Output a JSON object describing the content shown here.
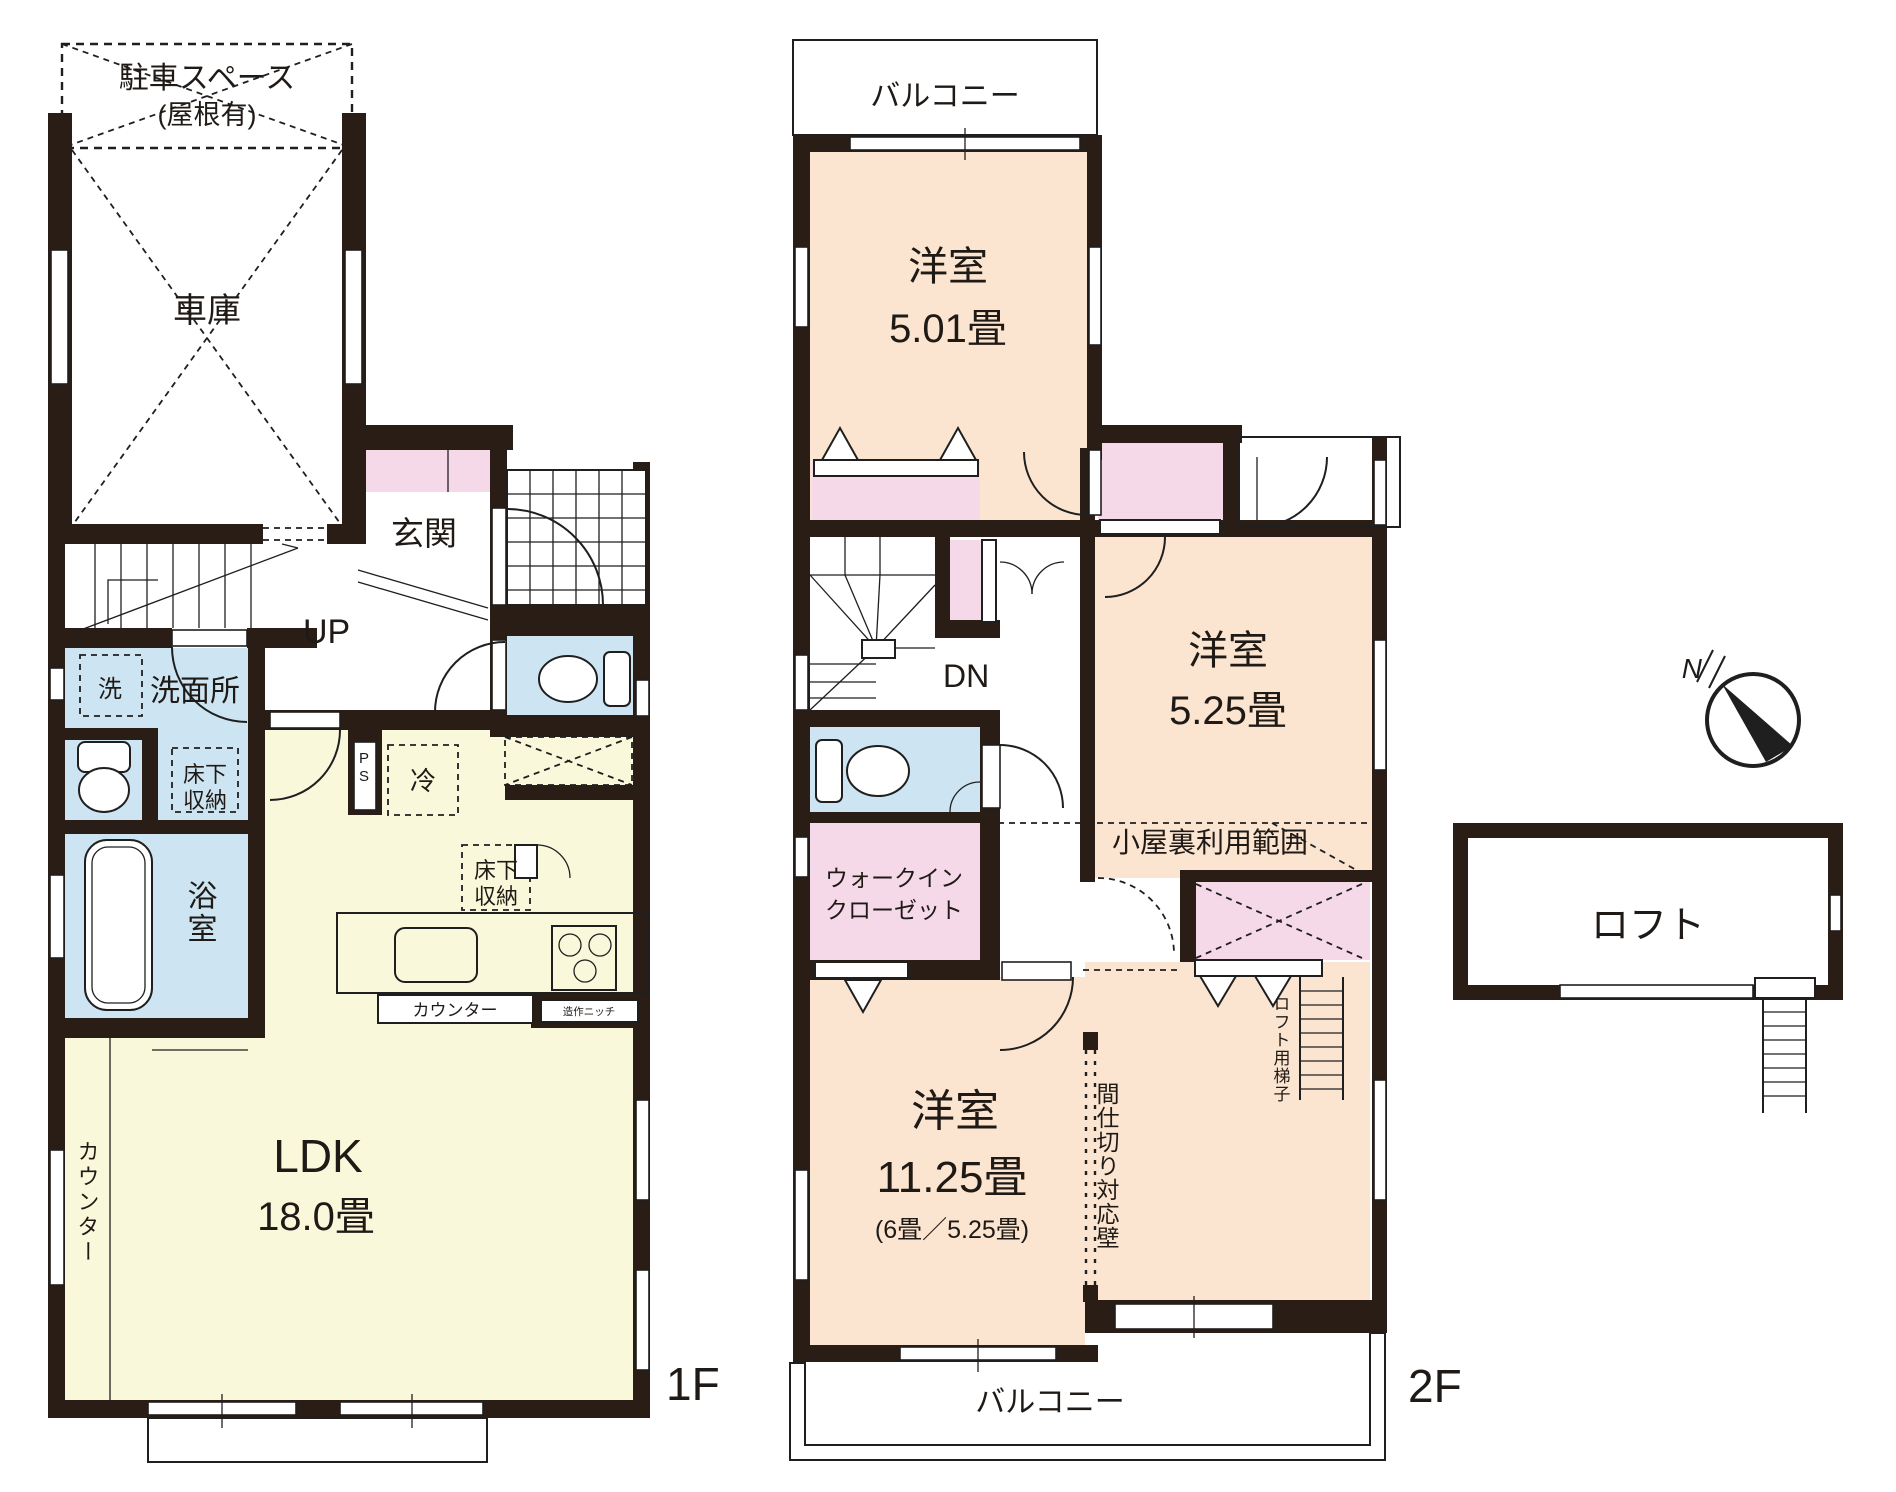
{
  "colors": {
    "wall": "#2a1d15",
    "ldk": "#faf8da",
    "bedroom": "#fbe5d1",
    "wet": "#cde5f2",
    "closet": "#f5d9e9"
  },
  "floor1": {
    "label": "1F",
    "parking": "駐車スペース",
    "parking_note": "(屋根有)",
    "garage": "車庫",
    "entrance": "玄関",
    "up": "UP",
    "washer": "洗",
    "washroom": "洗面所",
    "underfloor1": "床下",
    "underfloor2": "収納",
    "bathroom": "浴室",
    "fridge": "冷",
    "ps": "PS",
    "counter": "カウンター",
    "niche": "造作ニッチ",
    "ldk": "LDK",
    "ldk_size": "18.0畳"
  },
  "floor2": {
    "label": "2F",
    "balcony": "バルコニー",
    "room_a": "洋室",
    "room_a_size": "5.01畳",
    "dn": "DN",
    "room_b": "洋室",
    "room_b_size": "5.25畳",
    "wic1": "ウォークイン",
    "wic2": "クローゼット",
    "attic": "小屋裏利用範囲",
    "ladder": "ロフト用梯子",
    "partition": "間仕切り対応壁",
    "room_c": "洋室",
    "room_c_size": "11.25畳",
    "room_c_note": "(6畳／5.25畳)"
  },
  "loft": {
    "label": "ロフト"
  },
  "compass": {
    "north": "N"
  }
}
